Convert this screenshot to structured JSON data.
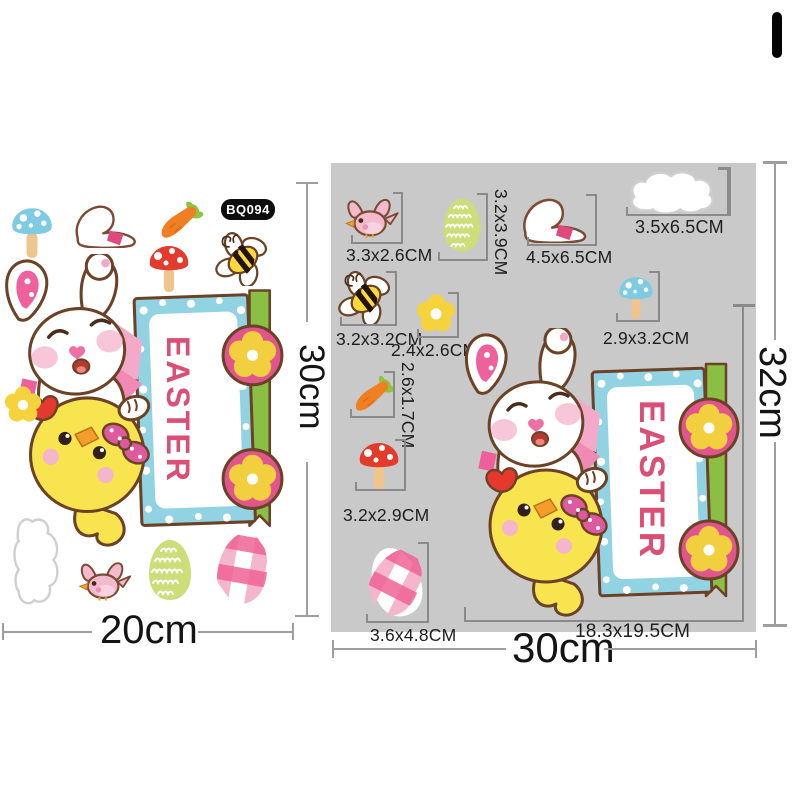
{
  "window": {
    "background": "#ffffff"
  },
  "left_sheet": {
    "product_code": "BQ094",
    "sign_text": "EASTER",
    "width_label": "20cm",
    "height_label": "30cm",
    "stickers": [
      "blue-mushroom",
      "bunny-slipper",
      "carrot",
      "red-mushroom",
      "bee",
      "easter-bunny-and-chick-sign",
      "yellow-flower",
      "cloud",
      "pink-bird",
      "green-egg",
      "pink-plaid-egg"
    ]
  },
  "right_panel": {
    "background": "#c9c9c9",
    "sign_text": "EASTER",
    "width_label": "30cm",
    "height_label": "32cm",
    "main_item": {
      "name": "easter-bunny-and-chick-sign",
      "size": "18.3x19.5CM"
    },
    "items": [
      {
        "name": "pink-bird",
        "size": "3.3x2.6CM"
      },
      {
        "name": "green-egg",
        "size": "3.2x3.9CM"
      },
      {
        "name": "bunny-slipper",
        "size": "4.5x6.5CM"
      },
      {
        "name": "cloud",
        "size": "3.5x6.5CM"
      },
      {
        "name": "bee",
        "size": "3.2x3.2CM"
      },
      {
        "name": "yellow-flower",
        "size": "2.4x2.6CM"
      },
      {
        "name": "blue-mushroom",
        "size": "2.9x3.2CM"
      },
      {
        "name": "carrot",
        "size": "2.6x1.7CM"
      },
      {
        "name": "red-mushroom",
        "size": "3.2x2.9CM"
      },
      {
        "name": "pink-plaid-egg",
        "size": "3.6x4.8CM"
      }
    ]
  },
  "colors": {
    "accent_pink": "#e0558b",
    "easter_text": "#d94f75",
    "sign_blue": "#92d3e3",
    "post_green": "#8abf44",
    "chick_yellow": "#f8e44e",
    "panel_gray": "#c9c9c9"
  }
}
